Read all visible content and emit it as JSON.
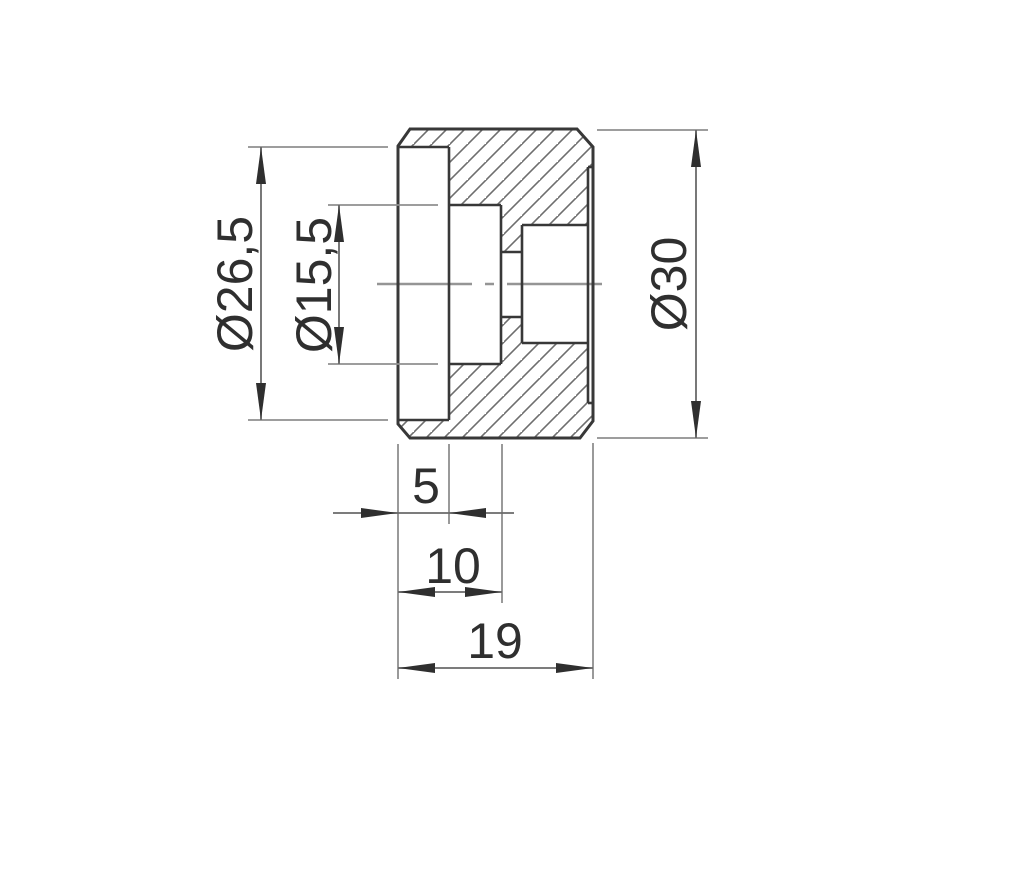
{
  "drawing": {
    "view": "cross-section technical drawing of cylindrical roller part",
    "dimensions": {
      "counterbore_diameter": "Ø26,5",
      "inner_bore_diameter": "Ø15,5",
      "outer_diameter": "Ø30",
      "counterbore_depth": "5",
      "bore_depth": "10",
      "overall_length": "19"
    },
    "colors": {
      "background": "#ffffff",
      "outline": "#383838",
      "dimension_line": "#6a6a6a",
      "extension_line": "#8f8f8f",
      "hatch": "#6e6e6e",
      "centerline": "#959595",
      "text": "#2f2f2f"
    }
  }
}
